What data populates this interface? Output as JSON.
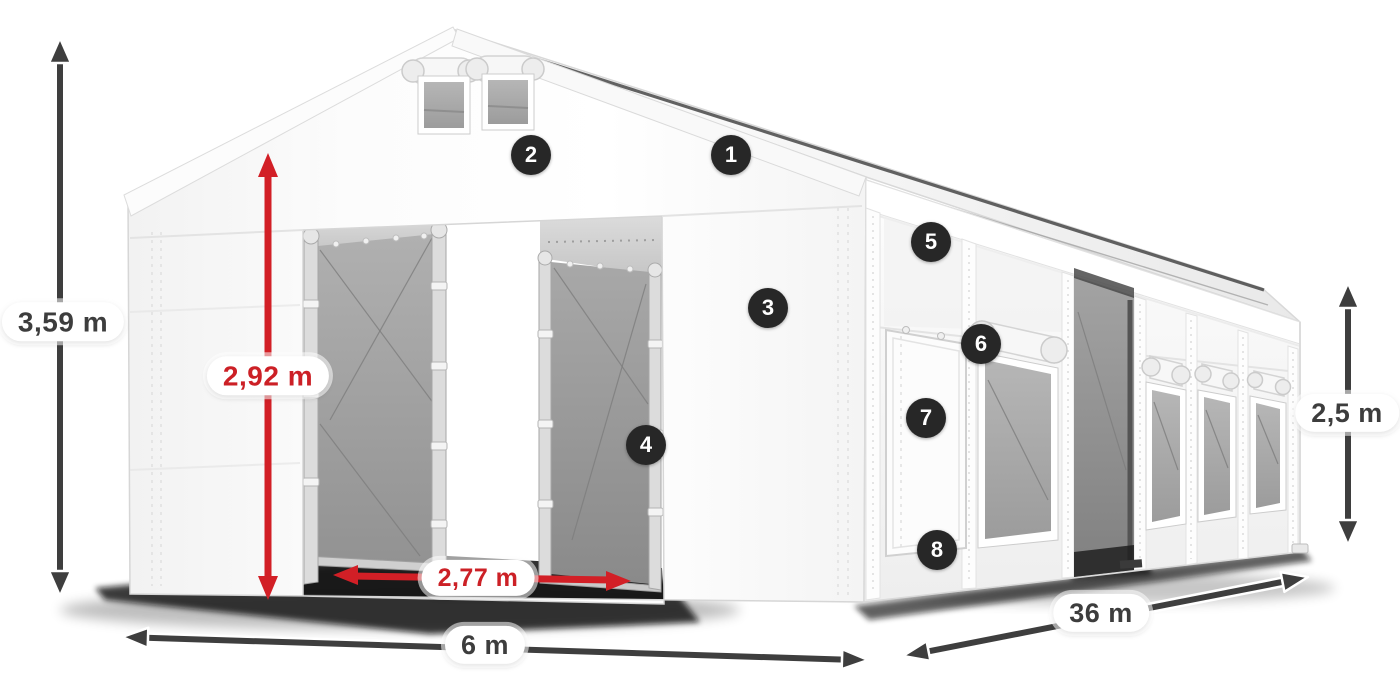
{
  "diagram": {
    "dims": {
      "total_height": "3,59 m",
      "door_height": "2,92 m",
      "door_width": "2,77 m",
      "front_width": "6 m",
      "side_length": "36 m",
      "side_height": "2,5 m"
    },
    "markers": [
      "1",
      "2",
      "3",
      "4",
      "5",
      "6",
      "7",
      "8"
    ],
    "colors": {
      "dim_arrow_gray": "#3e3e3e",
      "dim_arrow_red": "#d21f26",
      "marker_bg": "#272727",
      "marker_text": "#ffffff",
      "label_bg": "#ffffff",
      "label_text_gray": "#3d3d3d",
      "label_text_red": "#cc2026"
    }
  }
}
